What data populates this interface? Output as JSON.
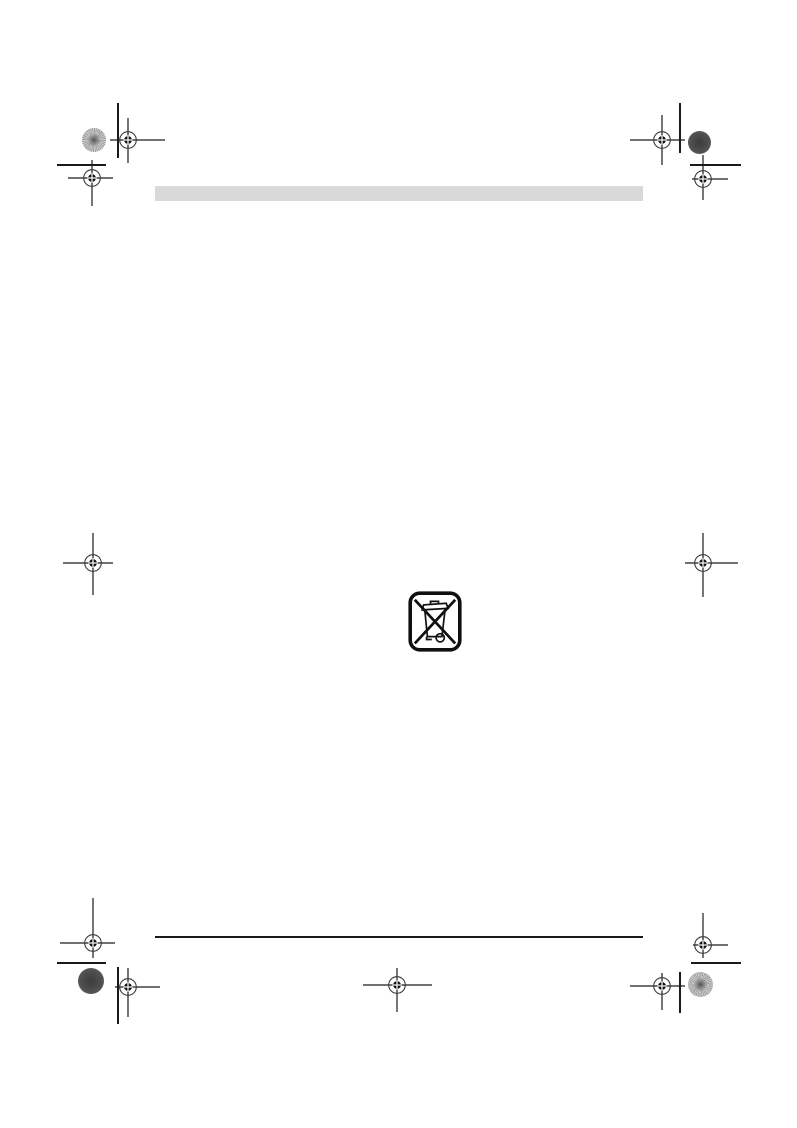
{
  "page": {
    "width": 797,
    "height": 1128,
    "background": "#ffffff",
    "ink_color": "#1a1a1a"
  },
  "document": {
    "header_bar": {
      "x": 155,
      "y": 186,
      "width": 488,
      "height": 15,
      "color": "#d9d9d9"
    },
    "footer_rule": {
      "x": 155,
      "y": 936,
      "width": 488,
      "height": 2,
      "color": "#1a1a1a"
    },
    "weee_symbol": {
      "icon": "weee-crossed-wheelie-bin-icon",
      "x": 408,
      "y": 591,
      "width": 54,
      "height": 61,
      "color": "#101010"
    }
  },
  "printer_marks": {
    "registration_marks": [
      {
        "cx": 128,
        "cy": 140,
        "left": 18,
        "right": 37,
        "up": 22,
        "down": 23
      },
      {
        "cx": 92,
        "cy": 178,
        "left": 24,
        "right": 21,
        "up": 18,
        "down": 28
      },
      {
        "cx": 662,
        "cy": 140,
        "left": 32,
        "right": 23,
        "up": 25,
        "down": 25
      },
      {
        "cx": 703,
        "cy": 179,
        "left": 11,
        "right": 25,
        "up": 24,
        "down": 21
      },
      {
        "cx": 93,
        "cy": 563,
        "left": 30,
        "right": 20,
        "up": 30,
        "down": 32
      },
      {
        "cx": 703,
        "cy": 563,
        "left": 18,
        "right": 35,
        "up": 30,
        "down": 34
      },
      {
        "cx": 93,
        "cy": 943,
        "left": 33,
        "right": 22,
        "up": 45,
        "down": 15
      },
      {
        "cx": 128,
        "cy": 987,
        "left": 13,
        "right": 32,
        "up": 19,
        "down": 30
      },
      {
        "cx": 397,
        "cy": 985,
        "left": 34,
        "right": 35,
        "up": 17,
        "down": 27
      },
      {
        "cx": 703,
        "cy": 945,
        "left": 10,
        "right": 25,
        "up": 32,
        "down": 13
      },
      {
        "cx": 662,
        "cy": 986,
        "left": 32,
        "right": 23,
        "up": 13,
        "down": 24
      }
    ],
    "color_patches": [
      {
        "cx": 94,
        "cy": 140,
        "r": 12,
        "variant": "halftone-light"
      },
      {
        "cx": 699,
        "cy": 142,
        "r": 11.5,
        "variant": "solid-dark"
      },
      {
        "cx": 91,
        "cy": 981,
        "r": 13,
        "variant": "solid-dark"
      },
      {
        "cx": 700,
        "cy": 984,
        "r": 12.5,
        "variant": "halftone-light"
      }
    ],
    "trim_lines": [
      {
        "x": 117,
        "y": 103,
        "length": 55,
        "orientation": "v"
      },
      {
        "x": 57,
        "y": 164,
        "length": 49,
        "orientation": "h"
      },
      {
        "x": 679,
        "y": 103,
        "length": 50,
        "orientation": "v"
      },
      {
        "x": 690,
        "y": 164,
        "length": 51,
        "orientation": "h"
      },
      {
        "x": 117,
        "y": 967,
        "length": 57,
        "orientation": "v"
      },
      {
        "x": 57,
        "y": 962,
        "length": 49,
        "orientation": "h"
      },
      {
        "x": 679,
        "y": 972,
        "length": 41,
        "orientation": "v"
      },
      {
        "x": 691,
        "y": 962,
        "length": 50,
        "orientation": "h"
      }
    ]
  }
}
